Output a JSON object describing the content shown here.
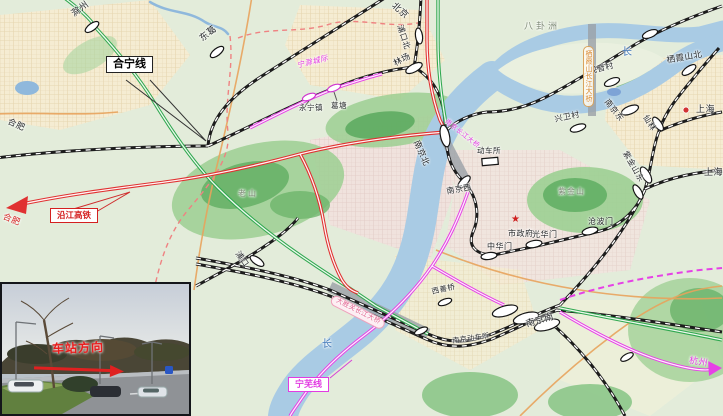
{
  "stations": {
    "chuzhou": "滁州",
    "dongge": "东葛",
    "pukoubei": "浦口北",
    "linchang": "林场",
    "yongningzhen": "永宁镇",
    "getang": "葛塘",
    "nanjingbei": "南京北",
    "dongchesuo": "动车所",
    "nanjingxi": "南京西",
    "guanyincun": "观音村",
    "nanjingdong": "南京东",
    "xingweicun": "兴卫村",
    "xianlin": "仙林",
    "zijinshandong": "紫金山东",
    "qixiashanbei": "栖霞山北",
    "zhonghuamen": "中华门",
    "guanghuamen": "光华门",
    "cangbomen": "沧波门",
    "pukou": "浦口",
    "xishanqiao": "西善桥",
    "nanjingnan": "南京南",
    "nanjingdongchesuo": "南京动车所"
  },
  "directions": {
    "beijing": "北京",
    "hefei_black": "合肥",
    "hefei_red": "合肥",
    "shanghai_a": "上海",
    "shanghai_b": "上海",
    "hangzhou": "杭州"
  },
  "lines": {
    "heningxian": "合宁线",
    "yanjiang": "沿江高铁",
    "ningwu": "宁芜线",
    "ningchu": "宁滁城际"
  },
  "bridges": {
    "changjiang": "南京长江大桥",
    "dashengguan": "大胜关长江大桥",
    "qixiashan": "栖霞山长江大桥"
  },
  "geo": {
    "baguazhou": "八卦洲",
    "chang_north": "长",
    "chang_south": "长",
    "laoshan": "老山",
    "zijinshan": "紫金山",
    "shizhengfu": "市政府",
    "gov_star": "★"
  },
  "inset": {
    "caption": "车站方向"
  },
  "colors": {
    "rail_black": "#1c1c1c",
    "hsr_red": "#e03131",
    "green_line": "#2fa84f",
    "magenta_line": "#e641e6",
    "water": "#a9cbe4",
    "road_orange": "#e8a35c"
  }
}
